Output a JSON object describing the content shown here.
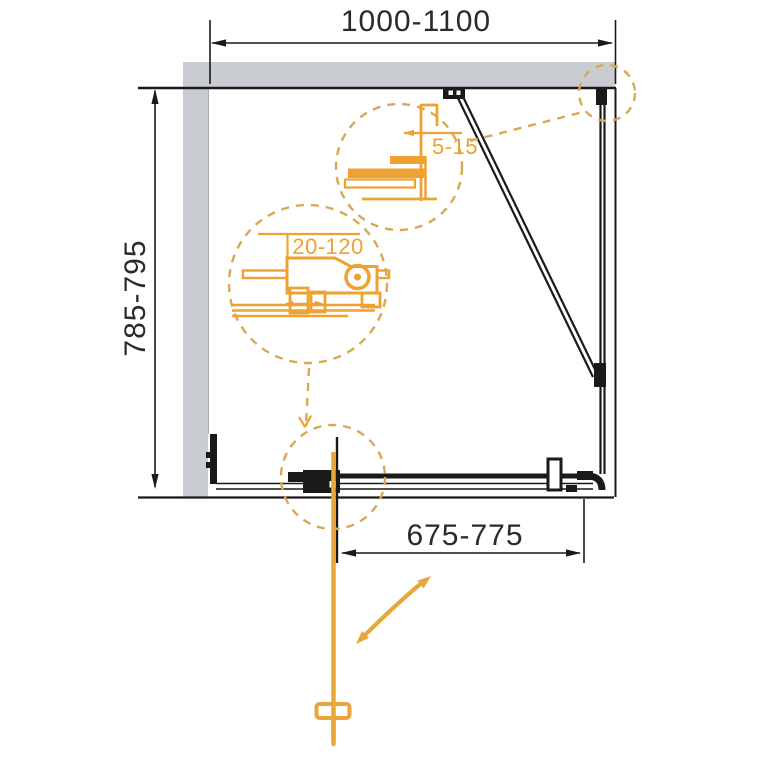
{
  "colors": {
    "background": "#ffffff",
    "wall_gray": "#c9ccd0",
    "wall_edge": "#aaaeb3",
    "line_black": "#1a1a1a",
    "text_dark": "#2a2a2a",
    "detail_orange": "#efa132",
    "dash_orange": "#d9a855",
    "handle_orange": "#e9a63b"
  },
  "diagram": {
    "dimensions": {
      "top": "1000-1100",
      "side": "785-795",
      "door": "675-775",
      "detail_small": "5-15",
      "detail_large": "20-120"
    }
  }
}
